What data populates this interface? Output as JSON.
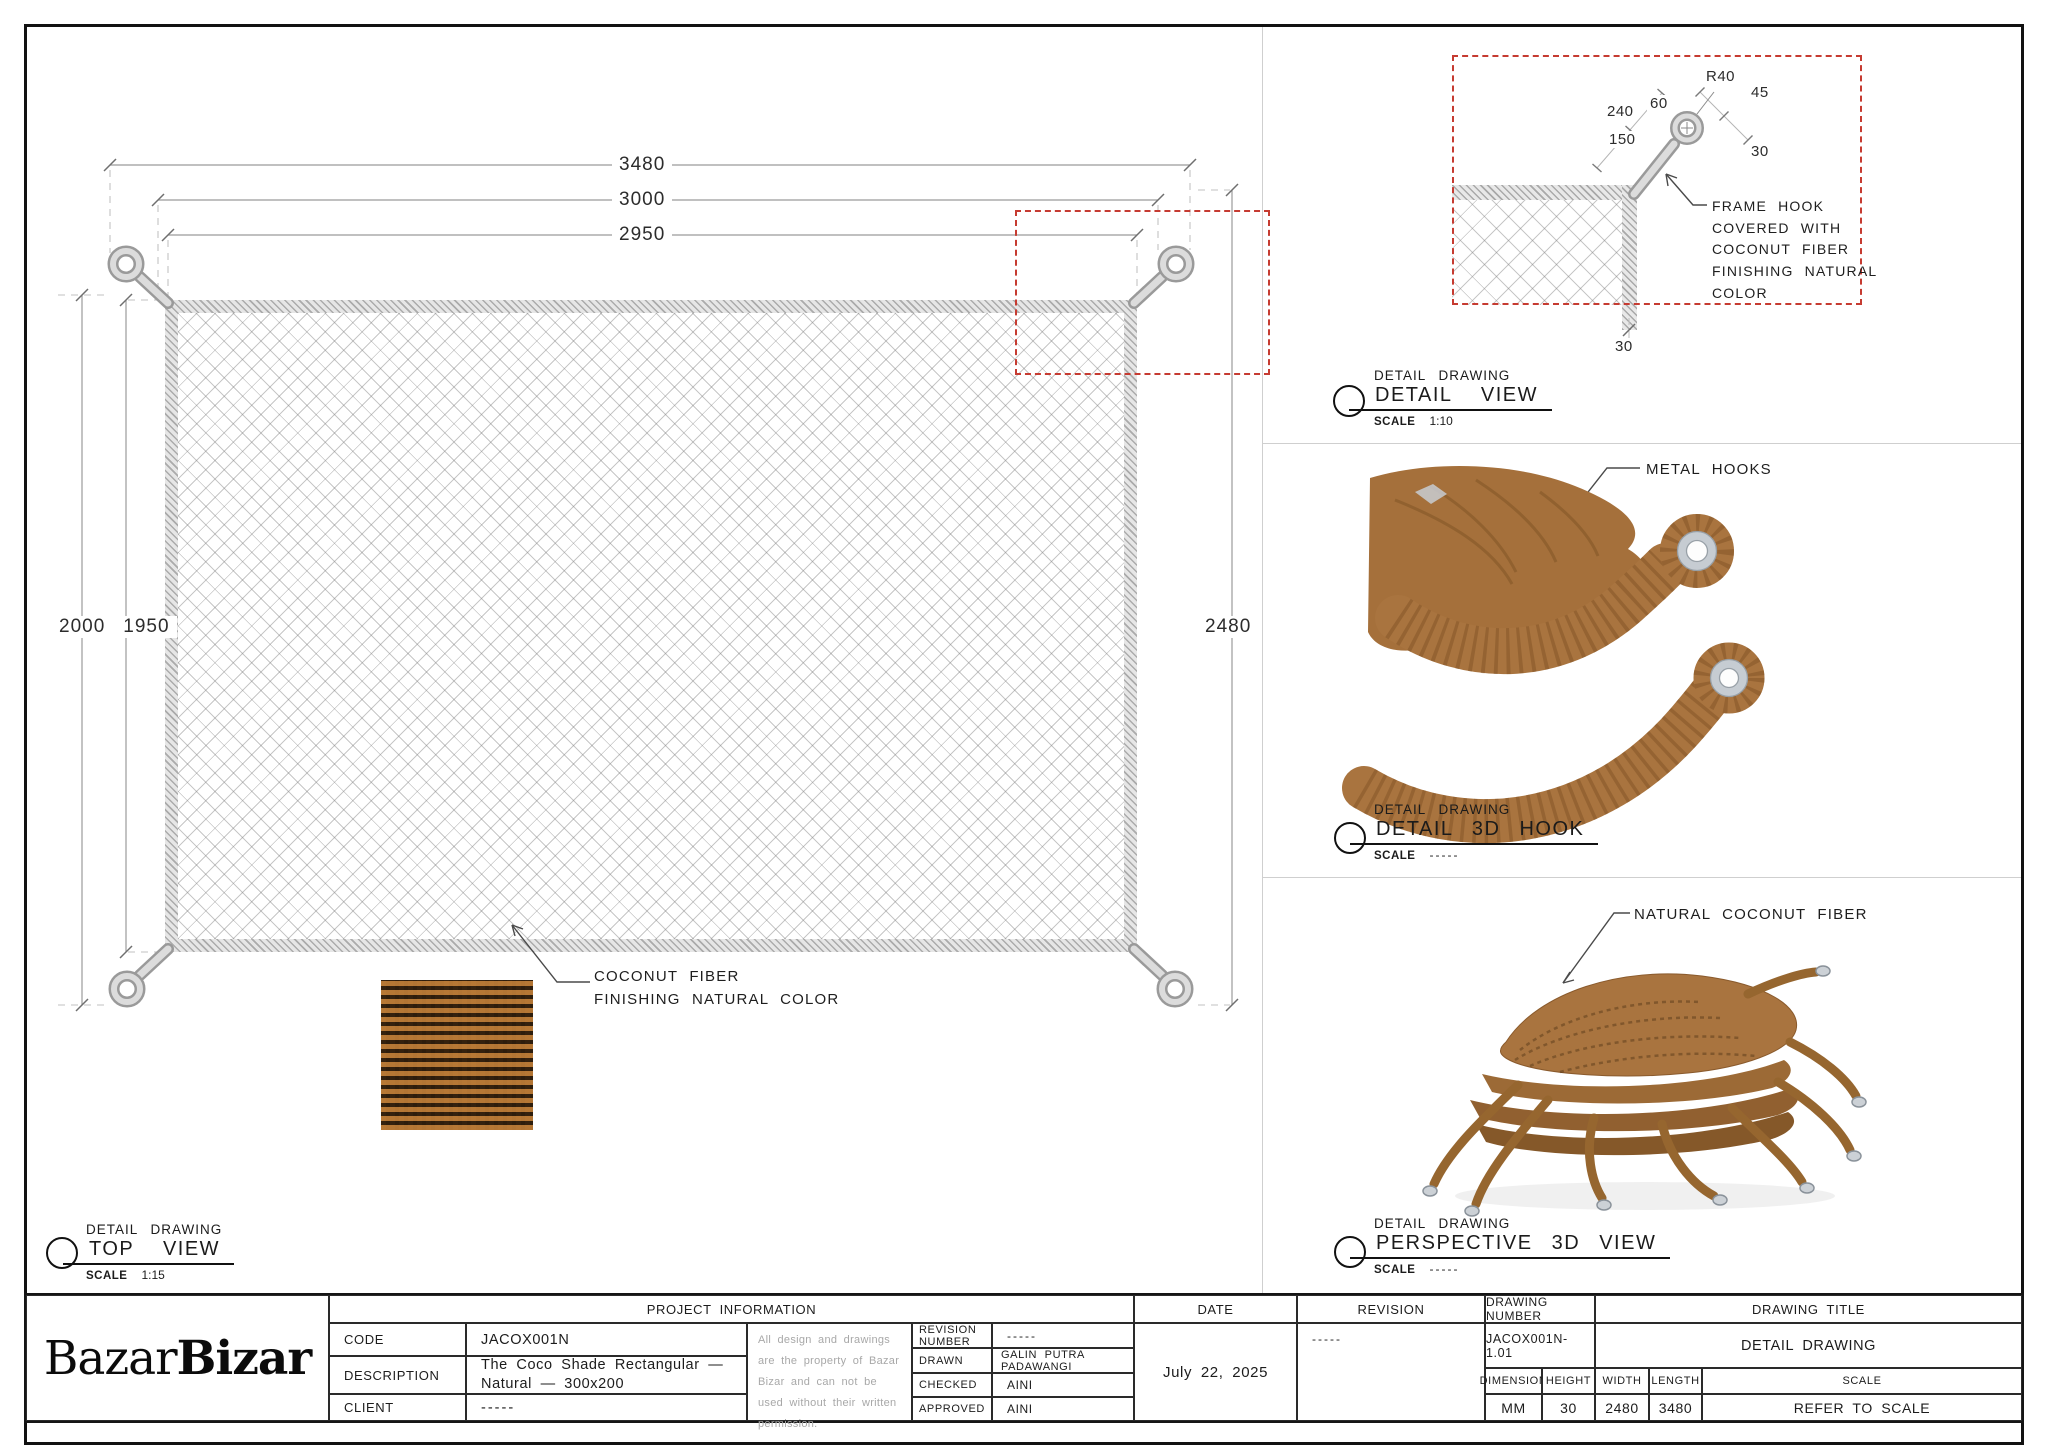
{
  "top_view": {
    "kicker": "DETAIL DRAWING",
    "title": "TOP VIEW",
    "scale_label": "SCALE",
    "scale_value": "1:15",
    "dim_3480": "3480",
    "dim_3000": "3000",
    "dim_2950": "2950",
    "dim_2000": "2000",
    "dim_1950": "1950",
    "dim_2480": "2480",
    "fiber_note": "COCONUT FIBER\nFINISHING NATURAL COLOR"
  },
  "detail_view": {
    "kicker": "DETAIL DRAWING",
    "title": "DETAIL VIEW",
    "scale_label": "SCALE",
    "scale_value": "1:10",
    "dims": {
      "r40": "R40",
      "d45": "45",
      "d60": "60",
      "d240": "240",
      "d150": "150",
      "d30_right": "30",
      "d30_bottom": "30"
    },
    "note": "FRAME HOOK\nCOVERED WITH\nCOCONUT FIBER\nFINISHING NATURAL\nCOLOR"
  },
  "hook_view": {
    "kicker": "DETAIL DRAWING",
    "title": "DETAIL 3D HOOK",
    "scale_label": "SCALE",
    "scale_value": "-----",
    "callout": "METAL HOOKS"
  },
  "perspective_view": {
    "kicker": "DETAIL DRAWING",
    "title": "PERSPECTIVE 3D VIEW",
    "scale_label": "SCALE",
    "scale_value": "-----",
    "callout": "NATURAL COCONUT FIBER"
  },
  "title_block": {
    "logo_regular": "Bazar",
    "logo_bold": "Bizar",
    "project_information_header": "PROJECT INFORMATION",
    "code_label": "CODE",
    "code_value": "JACOX001N",
    "description_label": "DESCRIPTION",
    "description_value": "The Coco Shade Rectangular — Natural — 300x200",
    "client_label": "CLIENT",
    "client_value": "-----",
    "disclaimer": "All design and drawings are the property of Bazar Bizar and can not be used without their written permission.",
    "revision_number_label": "REVISION NUMBER",
    "revision_number_value": "-----",
    "drawn_label": "DRAWN",
    "drawn_value": "GALIN PUTRA PADAWANGI",
    "checked_label": "CHECKED",
    "checked_value": "AINI",
    "approved_label": "APPROVED",
    "approved_value": "AINI",
    "date_header": "DATE",
    "date_value": "July 22, 2025",
    "revision_header": "REVISION",
    "revision_value": "-----",
    "drawing_number_header": "DRAWING NUMBER",
    "drawing_number_value": "JACOX001N-1.01",
    "drawing_title_header": "DRAWING TITLE",
    "drawing_title_value": "DETAIL DRAWING",
    "dimension_label": "DIMENSION",
    "dimension_value": "MM",
    "height_label": "HEIGHT",
    "height_value": "30",
    "width_label": "WIDTH",
    "width_value": "2480",
    "length_label": "LENGTH",
    "length_value": "3480",
    "scale_label": "SCALE",
    "scale_value": "REFER TO SCALE"
  },
  "colors": {
    "red_dashed": "#c63b31",
    "fiber_brown": "#a9743f",
    "metal_gray": "#c6ccd2"
  }
}
